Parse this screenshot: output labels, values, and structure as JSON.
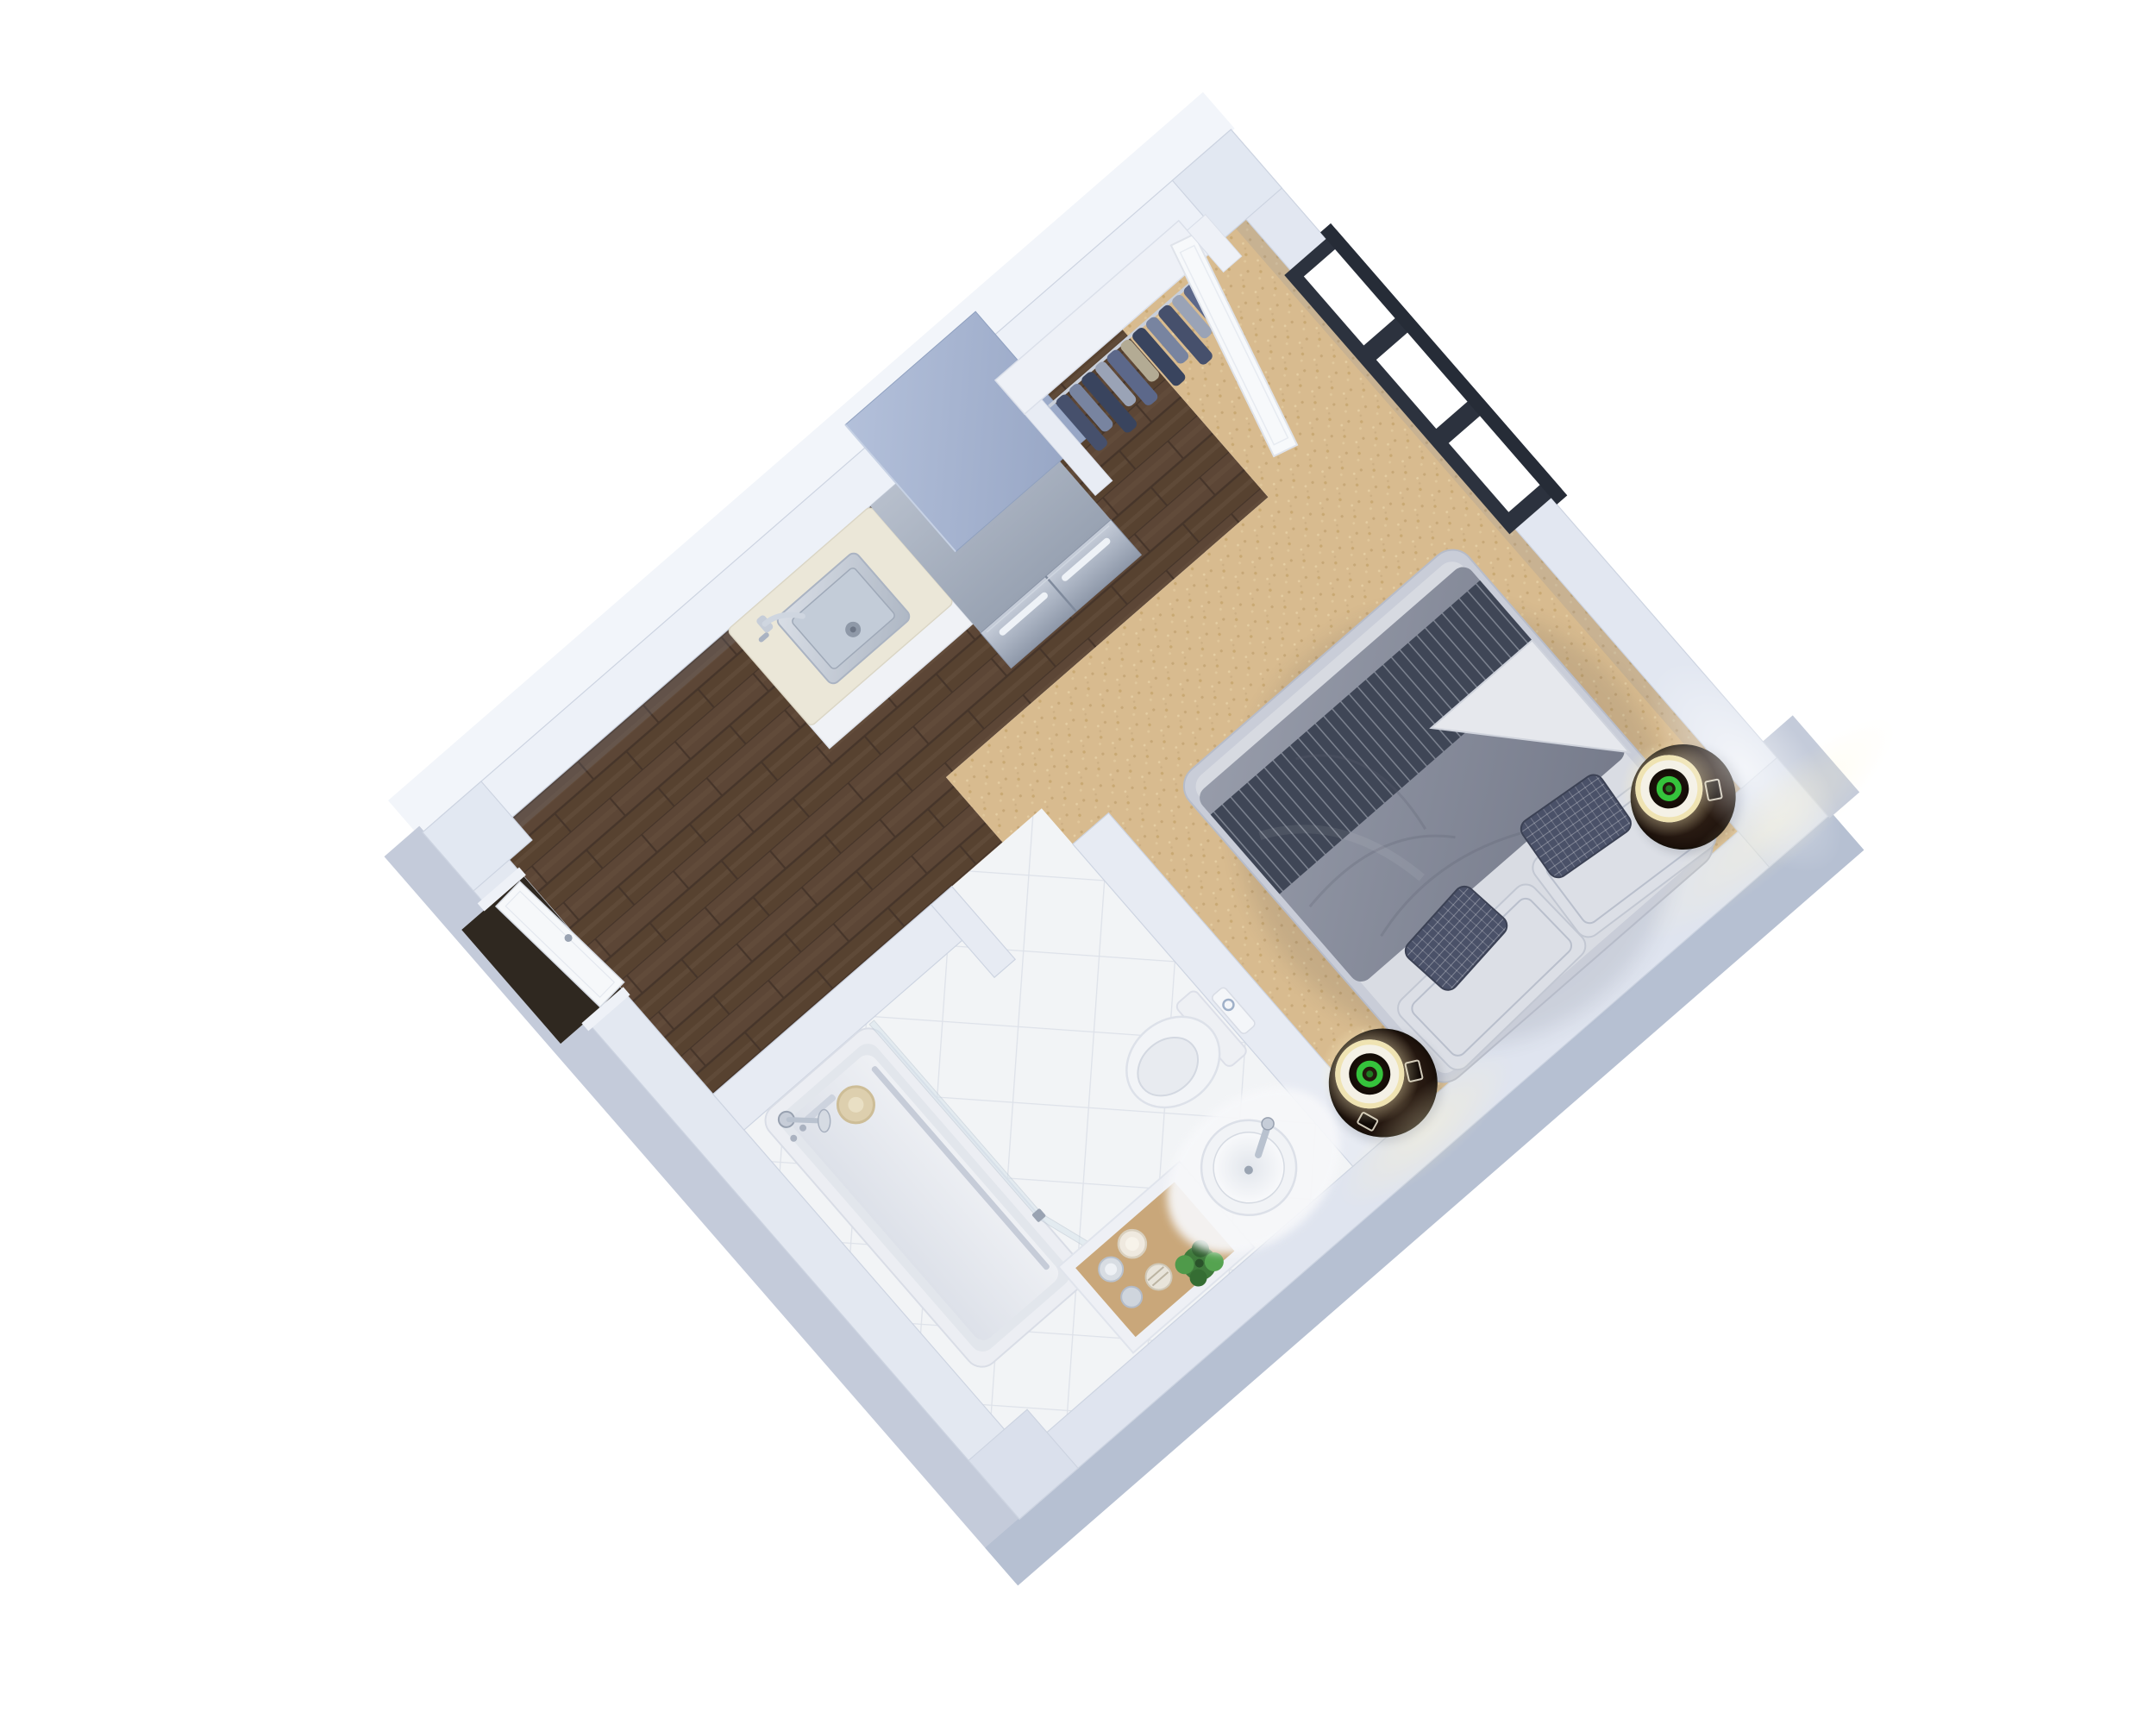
{
  "meta": {
    "description": "3D rendered floor plan of a studio apartment, axonometric top-down view on a white background",
    "view_rotation_deg": -41,
    "background": "#ffffff"
  },
  "palette": {
    "wall_top": "#e8ecf4",
    "wall_band_top": "#edf1f8",
    "wall_band_left": "#e3e8f1",
    "wall_band_right": "#e2e7f1",
    "wall_band_bottom": "#dfe4ef",
    "partition": "#e7ebf3",
    "wall_face": "#c4cbda",
    "wall_face_dark": "#b6c0d2",
    "wall_face_bright": "#f2f5fa",
    "window_frame": "#2c323e",
    "dark_opening": "#2f2820",
    "door_white": "#f6f8fa",
    "counter_cream": "#e9e4d3",
    "fridge_top": "#a6b3cf",
    "steel_light": "#d9dee6",
    "steel_dark": "#9aa4b4",
    "wood_dark": "#5c4636",
    "wood_line": "#46352a",
    "carpet": "#d8bb8f",
    "tile": "#f1f3f6",
    "tile_grout": "#dce0e8",
    "bed_frame": "#c9cdd8",
    "mattress": "#d7dae1",
    "sheet_white": "#e3e5ea",
    "stripe_dark": "#3f4656",
    "duvet_gray": "#8e93a1",
    "pillow_light": "#dcdfe6",
    "pillow_dark": "#4a5168",
    "table_brown": "#2a1c12",
    "lamp_shade": "#f4f1e6",
    "lamp_glow": "#fff3c6",
    "lamp_green": "#35c33c",
    "plant_green": "#3f7a3c",
    "vanity_wood": "#c9a77a",
    "tub_white": "#eceef3",
    "glass_tint": "#d7e4ec"
  },
  "scene": {
    "rooms": {
      "kitchen_label": "Kitchen / hallway with walnut plank floor",
      "bedroom_label": "Bedroom with beige carpet",
      "bathroom_label": "Bathroom with diagonal white tile",
      "closet_label": "Open closet with hanging clothes",
      "entry_label": "Entry with white door"
    },
    "kitchen": {
      "fridge_label": "Stainless steel french-door refrigerator",
      "sink_label": "Square stainless kitchen sink with chrome faucet",
      "counter_label": "Cream stone countertop on white cabinet"
    },
    "closet": {
      "shelf_label": "White closet shelf and soffit",
      "clothes_label": "Hanging shirts and jackets in blue and gray tones",
      "door_label": "Open white closet door leaning into room"
    },
    "bedroom": {
      "bed_label": "Double bed, gray duvet with dark pinstriped runner and folded white sheet",
      "pillows_label": "Two light bordered pillows and two dark accent pillows",
      "nightstand_left_label": "Round dark-wood nightstand with lit drum lamp (green glow core)",
      "nightstand_right_label": "Round dark-wood nightstand with lit drum lamp (green glow core)",
      "window_label": "Black-framed window with three panes"
    },
    "bathroom": {
      "tub_label": "White bathtub with chrome shower column and hand shower",
      "glass_label": "Frameless glass shower screen",
      "toilet_label": "Toilet with concealed cistern and round flush button",
      "basin_label": "Round white vessel sink with chrome mixer",
      "mat_label": "White fluffy bath mat",
      "vanity_label": "Inset wood vanity tray with jars, soap dishes and candles",
      "plant_label": "Small green potted plant"
    },
    "entry": {
      "door_label": "White entry door, closed, with handle",
      "opening_label": "Dark doorway opening in lower-left wall"
    }
  }
}
